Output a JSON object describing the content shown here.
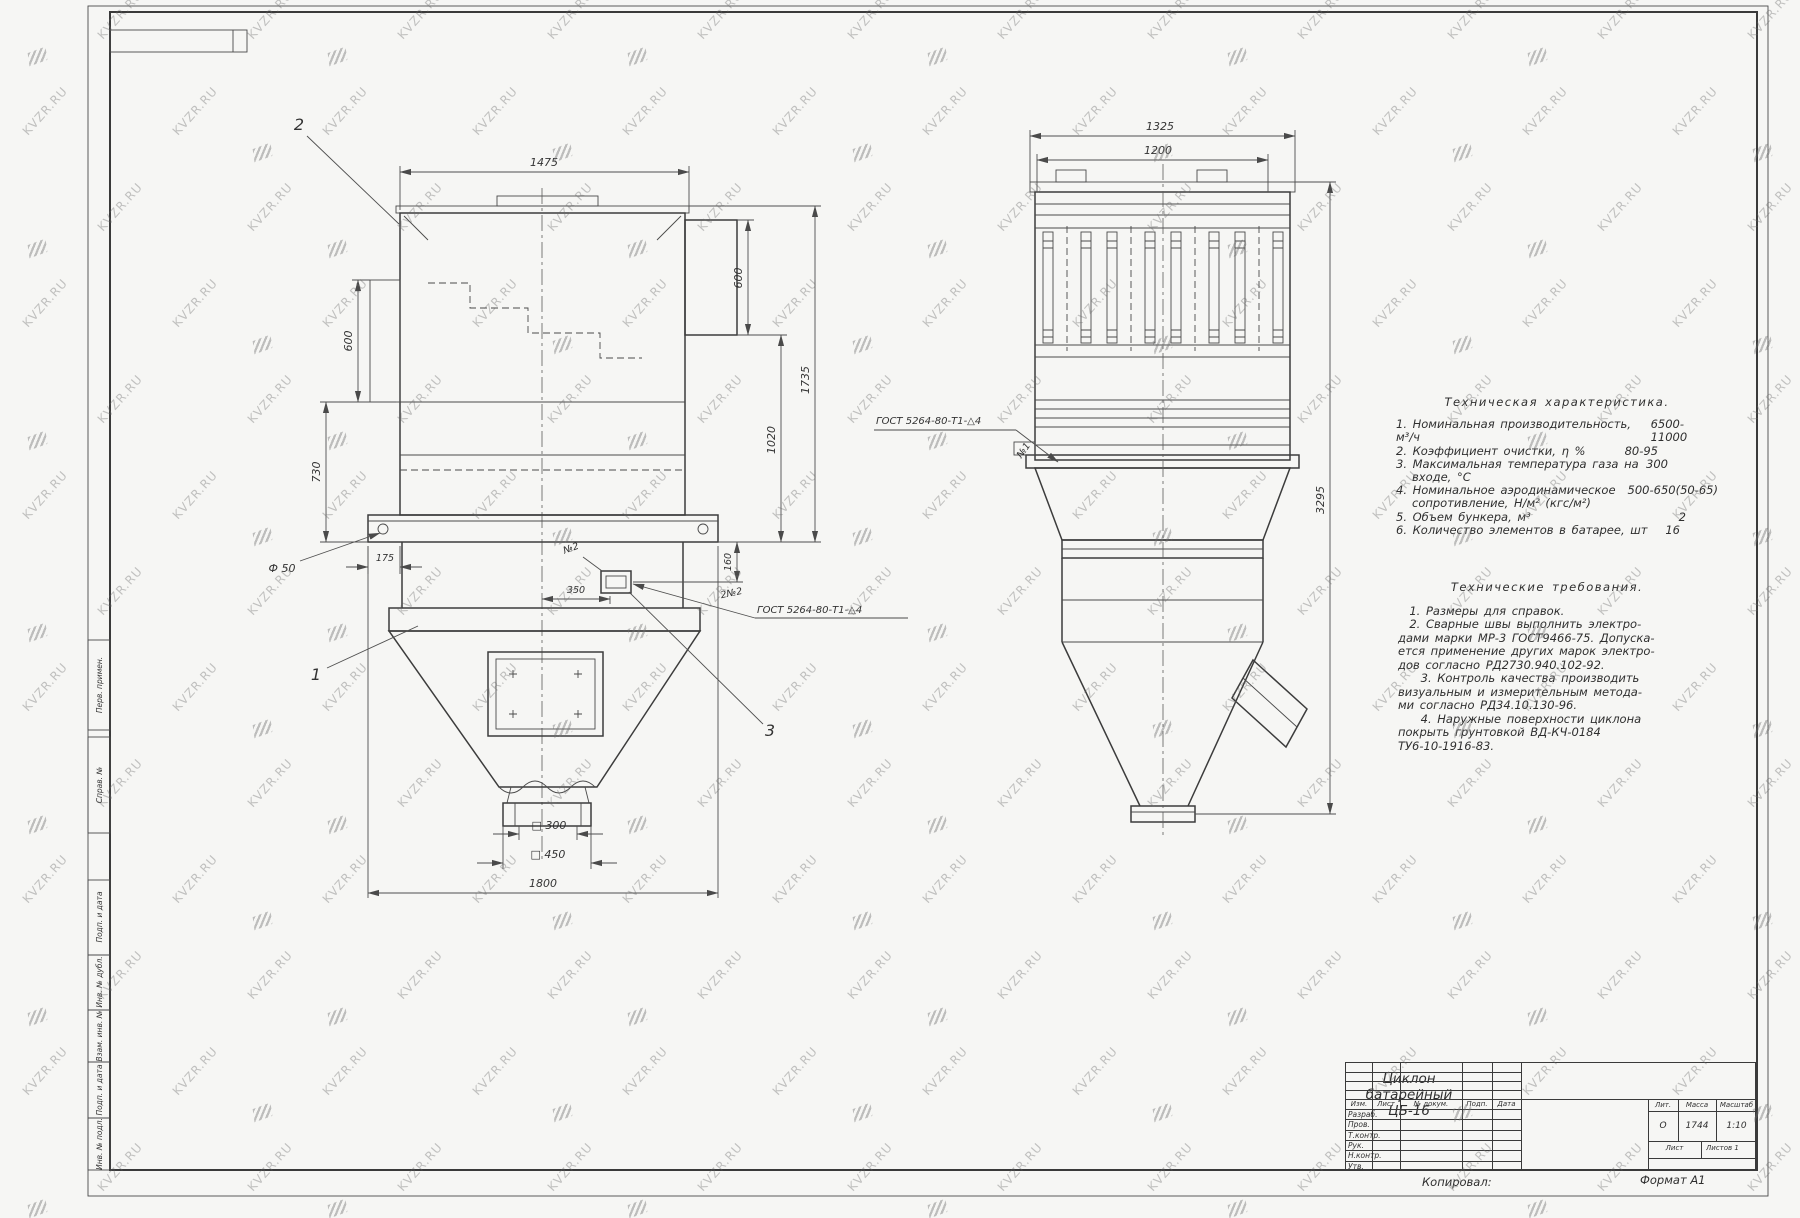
{
  "colors": {
    "line": "#3c3c3c",
    "paper": "#f6f6f4",
    "watermark": "#6e6e6e"
  },
  "watermark": {
    "text": "KVZR.RU"
  },
  "frame": {
    "margin_labels": [
      "Перв. примен.",
      "Справ. №",
      "Подп. и дата",
      "Инв. № дубл.",
      "Взам. инв. №",
      "Подп. и дата",
      "Инв. № подл."
    ]
  },
  "left_view": {
    "dim_top": "1475",
    "dim_left_upper": "600",
    "dim_left_lower": "730",
    "dim_right_upper": "600",
    "dim_right_mid": "1020",
    "dim_right_total": "1735",
    "dim_phi": "Ф 50",
    "dim_175": "175",
    "dim_350": "350",
    "dim_160": "160",
    "dim_sq300": "□ 300",
    "dim_sq450": "□ 450",
    "dim_bottom": "1800",
    "callout_1": "1",
    "callout_2": "2",
    "callout_3": "3",
    "weld_small": "№2",
    "weld_count": "2№2",
    "weld_gost": "ГОСТ 5264-80-Т1-△4"
  },
  "right_view": {
    "dim_top_outer": "1325",
    "dim_top_inner": "1200",
    "dim_height": "3295",
    "weld_gost": "ГОСТ 5264-80-Т1-△4",
    "weld_num": "№1"
  },
  "tech_characteristics": {
    "title": "Техническая характеристика.",
    "rows": [
      {
        "t": "1. Номинальная производительность, м³/ч",
        "v": "6500-11000"
      },
      {
        "t": "2. Коэффициент очистки, η %",
        "v": "80-95"
      },
      {
        "t": "3. Максимальная температура газа на",
        "v": "300"
      },
      {
        "t": "входе, °С",
        "v": ""
      },
      {
        "t": "4. Номинальное аэродинамическое",
        "v": "500-650(50-65)"
      },
      {
        "t": "сопротивление, Н/м² (кгс/м²)",
        "v": ""
      },
      {
        "t": "5. Объем бункера, м³",
        "v": "2"
      },
      {
        "t": "6. Количество элементов в батарее, шт",
        "v": "16"
      }
    ]
  },
  "tech_requirements": {
    "title": "Технические требования.",
    "lines": [
      "  1. Размеры для справок.",
      "  2. Сварные швы выполнить электро-",
      "дами марки МР-3 ГОСТ9466-75. Допуска-",
      "ется применение других марок электро-",
      "дов согласно РД2730.940.102-92.",
      "    3. Контроль качества производить",
      "визуальным и измерительным метода-",
      "ми согласно РД34.10.130-96.",
      "    4. Наружные поверхности циклона",
      "покрыть грунтовкой ВД-КЧ-0184",
      "ТУ6-10-1916-83."
    ]
  },
  "title_block": {
    "doc_title_1": "Циклон",
    "doc_title_2": "батарейный",
    "doc_title_3": "ЦБ-16",
    "cols": [
      "Изм.",
      "Лист",
      "№ докум.",
      "Подп.",
      "Дата"
    ],
    "rows": [
      "Разраб.",
      "Пров.",
      "Т.контр.",
      "Рук.",
      "Н.контр.",
      "Утв."
    ],
    "lit_label": "Лит.",
    "mass_label": "Масса",
    "scale_label": "Масштаб",
    "lit_value": "О",
    "mass_value": "1744",
    "scale_value": "1:10",
    "sheet_label": "Лист",
    "sheets_label": "Листов",
    "sheets_value": "1"
  },
  "footer": {
    "copied": "Копировал:",
    "format": "Формат А1"
  }
}
